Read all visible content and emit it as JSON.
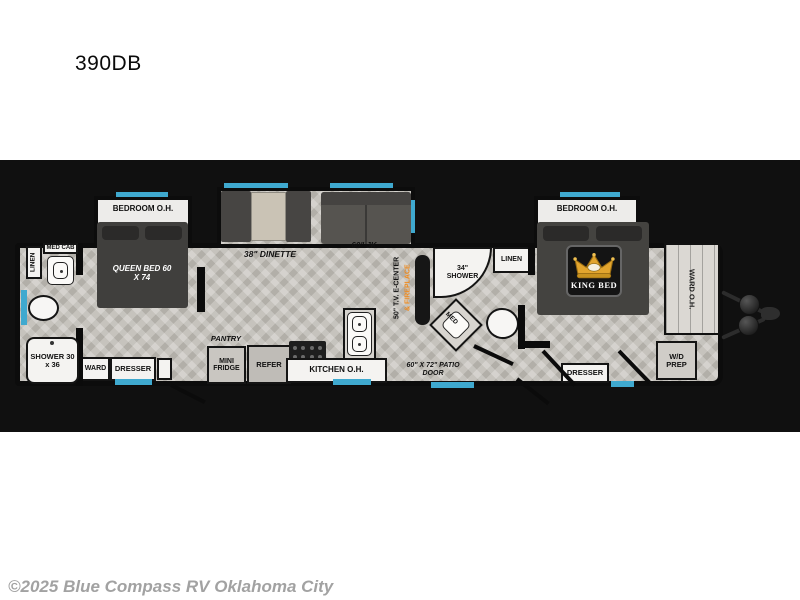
{
  "page": {
    "title": "390DB",
    "copyright": "©2025 Blue Compass RV Oklahoma City"
  },
  "colors": {
    "band_background": "#101010",
    "window_accent": "#3fa9cf",
    "fireplace_text": "#ef8a1d",
    "crown_gold": "#e2a52e",
    "floor": "#c6c3bd"
  },
  "floorplan": {
    "front_bedroom": {
      "overhead_label": "BEDROOM O.H.",
      "bed_label": "QUEEN BED 60 X 74",
      "ward_label": "WARD",
      "dresser_label": "DRESSER"
    },
    "front_bath": {
      "linen_label": "LINEN",
      "med_cab_label": "MED CAB",
      "shower_label": "SHOWER 30 x 36"
    },
    "living": {
      "dinette_label": "38\" DINETTE",
      "sofa_label": "60\" JK",
      "tv_label": "50\" T.V. E-CENTER",
      "fireplace_label": "& FIREPLACE"
    },
    "kitchen": {
      "pantry_label": "PANTRY",
      "mini_fridge_label": "MINI FRIDGE",
      "refer_label": "REFER",
      "overhead_label": "KITCHEN O.H.",
      "patio_door_label": "60\" X 72\" PATIO DOOR"
    },
    "mid_bath": {
      "shower_label": "34\" SHOWER",
      "linen_label": "LINEN",
      "med_label": "MED"
    },
    "rear_bedroom": {
      "overhead_label": "BEDROOM O.H.",
      "bed_label": "KING BED",
      "dresser_label": "DRESSER",
      "ward_oh_label": "WARD O.H.",
      "wd_prep_label": "W/D PREP"
    }
  }
}
